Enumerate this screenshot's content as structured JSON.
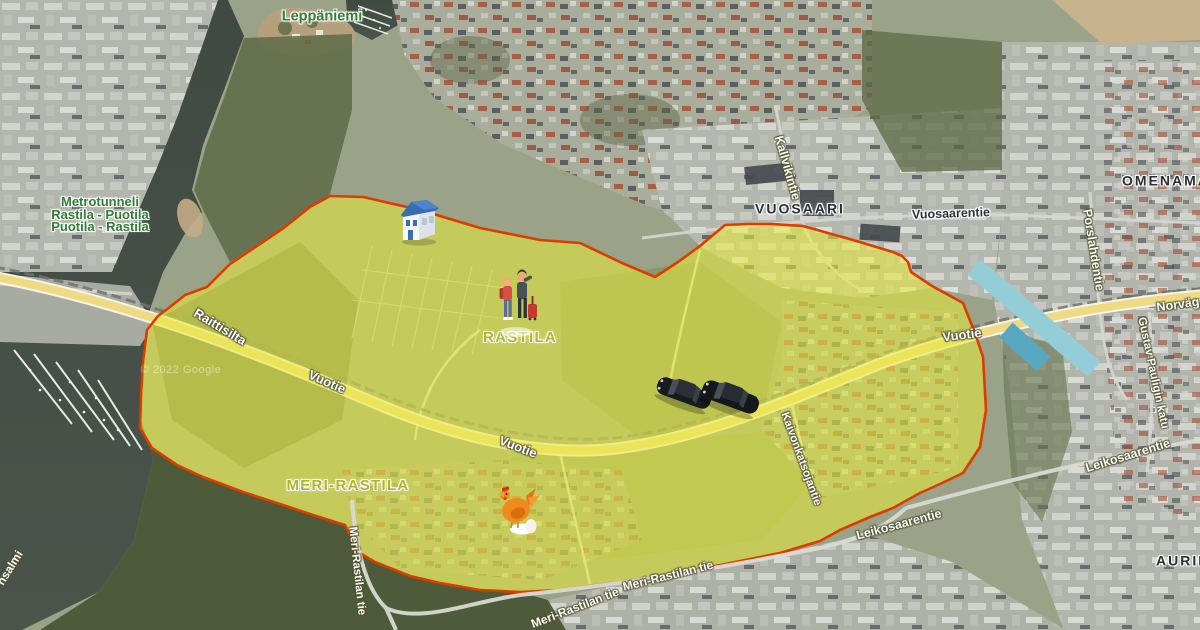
{
  "map": {
    "attribution": "© 2022 Google",
    "labels": {
      "leppaniemi": "Leppäniemi",
      "metrotunneli_line1": "Metrotunneli",
      "metrotunneli_line2": "Rastila - Puotila",
      "metrotunneli_line3": "Puotila - Rastila",
      "vuosaari": "VUOSAARI",
      "omenamaki_partial": "OMENAMÄ",
      "aurinkolahti_partial": "AURIN",
      "rastila": "RASTILA",
      "meri_rastila": "MERI-RASTILA",
      "vuosaarentie": "Vuosaarentie",
      "kallvikintie": "Kallvikintie",
      "porslahdentie": "Porslahdentie",
      "norvagen_partial": "Norväg",
      "gustav_pauligin_katu": "Gustav Pauligin katu",
      "leikosaarentie_east": "Leikosaarentie",
      "leikosaarentie_south": "Leikosaarentie",
      "vuotie_west": "Vuotie",
      "vuotie_mid": "Vuotie",
      "vuotie_east": "Vuotie",
      "raittisilta": "Raittisilta",
      "kaivonkatsojantie": "Kaivonkatsojantie",
      "meri_rastilan_tie_vertical": "Meri-Rastilan tie",
      "meri_rastilan_tie_south1": "Meri-Rastilan tie",
      "meri_rastilan_tie_south2": "Meri-Rastilan tie",
      "salmi_partial": "nsalmi"
    },
    "overlay": {
      "name": "highlighted-area-rastila-meri-rastila",
      "fill": "#e7ec39",
      "fill_opacity": 0.56,
      "stroke": "#dd3c00"
    },
    "markers": [
      {
        "name": "blue-house-marker"
      },
      {
        "name": "travelers-marker"
      },
      {
        "name": "black-car-marker-1"
      },
      {
        "name": "black-car-marker-2"
      },
      {
        "name": "chicken-marker"
      }
    ],
    "colors": {
      "water": "#454f47",
      "highway": "#eeda83",
      "metro_band": "#93ced8",
      "forest": "#4e5b3b",
      "urban": "#b3b6ac"
    }
  }
}
